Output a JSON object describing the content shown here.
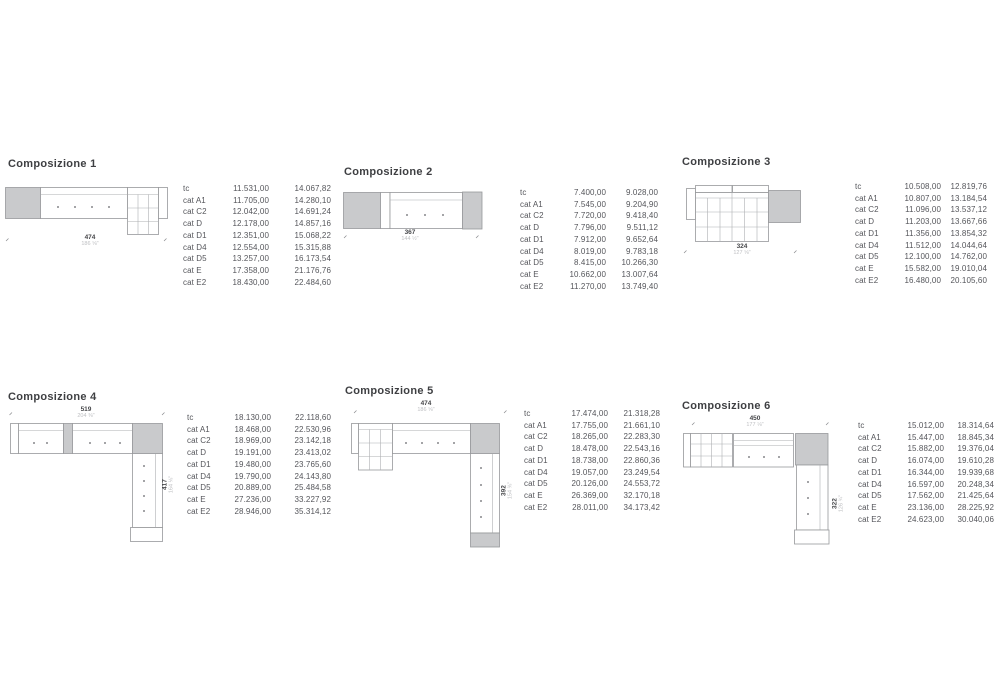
{
  "colors": {
    "background": "#ffffff",
    "title_text": "#3e3f42",
    "table_text": "#55565b",
    "sofa_fill_gray": "#c9cacc",
    "sofa_outline": "#97989b",
    "dim_number": "#46474a",
    "dim_inches": "#bfc0c3"
  },
  "row_labels": [
    "tc",
    "cat A1",
    "cat C2",
    "cat D",
    "cat D1",
    "cat D4",
    "cat D5",
    "cat E",
    "cat E2"
  ],
  "compositions": [
    {
      "title": "Composizione 1",
      "dims": {
        "w_cm": "474",
        "w_in": "186 ⅝\""
      },
      "prices": [
        [
          "11.531,00",
          "14.067,82"
        ],
        [
          "11.705,00",
          "14.280,10"
        ],
        [
          "12.042,00",
          "14.691,24"
        ],
        [
          "12.178,00",
          "14.857,16"
        ],
        [
          "12.351,00",
          "15.068,22"
        ],
        [
          "12.554,00",
          "15.315,88"
        ],
        [
          "13.257,00",
          "16.173,54"
        ],
        [
          "17.358,00",
          "21.176,76"
        ],
        [
          "18.430,00",
          "22.484,60"
        ]
      ]
    },
    {
      "title": "Composizione 2",
      "dims": {
        "w_cm": "367",
        "w_in": "144 ½\""
      },
      "prices": [
        [
          "7.400,00",
          "9.028,00"
        ],
        [
          "7.545,00",
          "9.204,90"
        ],
        [
          "7.720,00",
          "9.418,40"
        ],
        [
          "7.796,00",
          "9.511,12"
        ],
        [
          "7.912,00",
          "9.652,64"
        ],
        [
          "8.019,00",
          "9.783,18"
        ],
        [
          "8.415,00",
          "10.266,30"
        ],
        [
          "10.662,00",
          "13.007,64"
        ],
        [
          "11.270,00",
          "13.749,40"
        ]
      ]
    },
    {
      "title": "Composizione 3",
      "dims": {
        "w_cm": "324",
        "w_in": "127 ⅝\""
      },
      "prices": [
        [
          "10.508,00",
          "12.819,76"
        ],
        [
          "10.807,00",
          "13.184,54"
        ],
        [
          "11.096,00",
          "13.537,12"
        ],
        [
          "11.203,00",
          "13.667,66"
        ],
        [
          "11.356,00",
          "13.854,32"
        ],
        [
          "11.512,00",
          "14.044,64"
        ],
        [
          "12.100,00",
          "14.762,00"
        ],
        [
          "15.582,00",
          "19.010,04"
        ],
        [
          "16.480,00",
          "20.105,60"
        ]
      ]
    },
    {
      "title": "Composizione 4",
      "dims": {
        "w_cm": "519",
        "w_in": "204 ⅜\"",
        "h_cm": "417",
        "h_in": "164 ⅛\""
      },
      "prices": [
        [
          "18.130,00",
          "22.118,60"
        ],
        [
          "18.468,00",
          "22.530,96"
        ],
        [
          "18.969,00",
          "23.142,18"
        ],
        [
          "19.191,00",
          "23.413,02"
        ],
        [
          "19.480,00",
          "23.765,60"
        ],
        [
          "19.790,00",
          "24.143,80"
        ],
        [
          "20.889,00",
          "25.484,58"
        ],
        [
          "27.236,00",
          "33.227,92"
        ],
        [
          "28.946,00",
          "35.314,12"
        ]
      ]
    },
    {
      "title": "Composizione 5",
      "dims": {
        "w_cm": "474",
        "w_in": "186 ⅝\"",
        "h_cm": "392",
        "h_in": "154 ⅜\""
      },
      "prices": [
        [
          "17.474,00",
          "21.318,28"
        ],
        [
          "17.755,00",
          "21.661,10"
        ],
        [
          "18.265,00",
          "22.283,30"
        ],
        [
          "18.478,00",
          "22.543,16"
        ],
        [
          "18.738,00",
          "22.860,36"
        ],
        [
          "19.057,00",
          "23.249,54"
        ],
        [
          "20.126,00",
          "24.553,72"
        ],
        [
          "26.369,00",
          "32.170,18"
        ],
        [
          "28.011,00",
          "34.173,42"
        ]
      ]
    },
    {
      "title": "Composizione 6",
      "dims": {
        "w_cm": "450",
        "w_in": "177 ⅛\"",
        "h_cm": "322",
        "h_in": "126 ¾\""
      },
      "prices": [
        [
          "15.012,00",
          "18.314,64"
        ],
        [
          "15.447,00",
          "18.845,34"
        ],
        [
          "15.882,00",
          "19.376,04"
        ],
        [
          "16.074,00",
          "19.610,28"
        ],
        [
          "16.344,00",
          "19.939,68"
        ],
        [
          "16.597,00",
          "20.248,34"
        ],
        [
          "17.562,00",
          "21.425,64"
        ],
        [
          "23.136,00",
          "28.225,92"
        ],
        [
          "24.623,00",
          "30.040,06"
        ]
      ]
    }
  ]
}
